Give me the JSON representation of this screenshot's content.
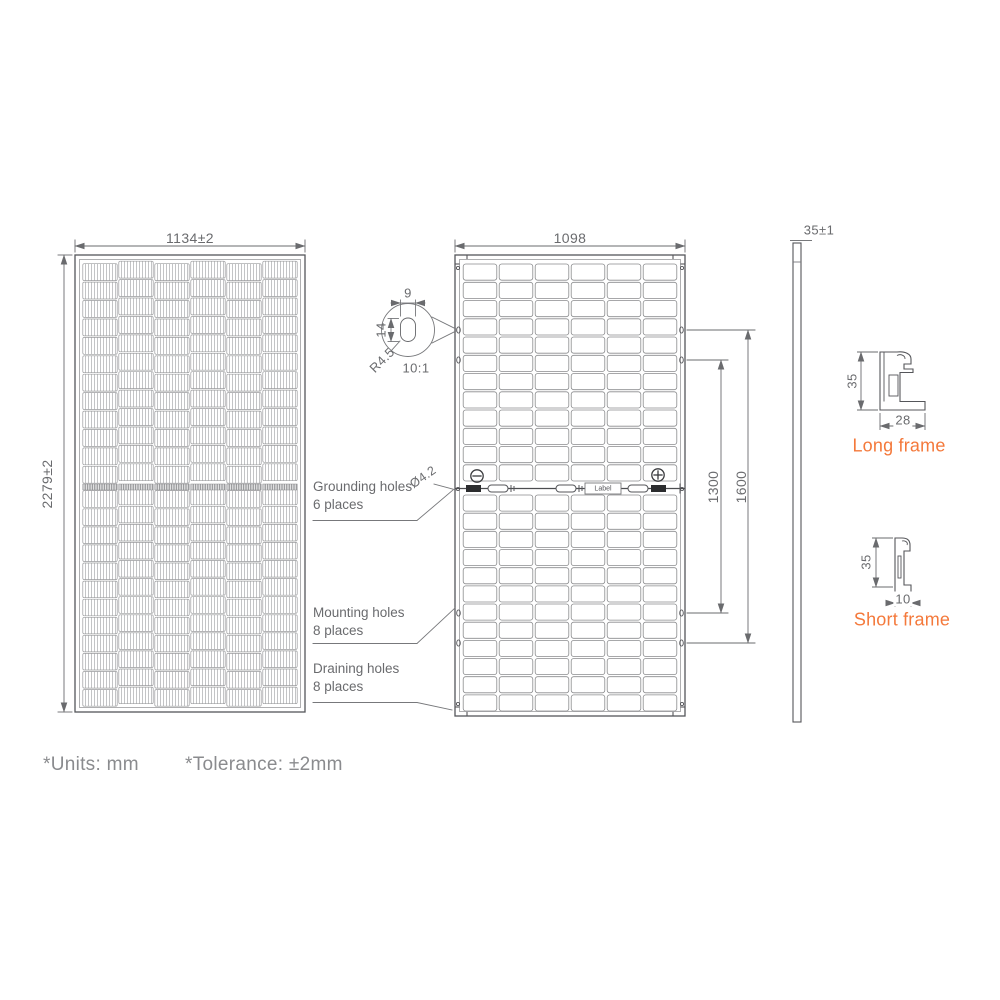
{
  "drawing": {
    "front_view": {
      "width_dim": "1134±2",
      "height_dim": "2279±2"
    },
    "back_view": {
      "width_dim": "1098",
      "mounting_span_inner": "1300",
      "mounting_span_outer": "1600",
      "grounding_hole_dia": "Ø4.2",
      "junction_label": "Label"
    },
    "hole_detail": {
      "width": "9",
      "height": "14",
      "radius": "R4.5",
      "scale": "10:1"
    },
    "callouts": {
      "grounding": {
        "line1": "Grounding holes",
        "line2": "6 places"
      },
      "mounting": {
        "line1": "Mounting holes",
        "line2": "8 places"
      },
      "draining": {
        "line1": "Draining holes",
        "line2": "8 places"
      }
    },
    "side_view": {
      "thickness_dim": "35±1"
    },
    "long_frame": {
      "height_dim": "35",
      "width_dim": "28",
      "label": "Long frame"
    },
    "short_frame": {
      "height_dim": "35",
      "width_dim": "10",
      "label": "Short frame"
    },
    "notes": {
      "units": "*Units: mm",
      "tolerance": "*Tolerance: ±2mm"
    },
    "colors": {
      "line": "#55565a",
      "dim_text": "#6a6b6e",
      "accent": "#f4793b",
      "note": "#8a8b8e"
    }
  }
}
